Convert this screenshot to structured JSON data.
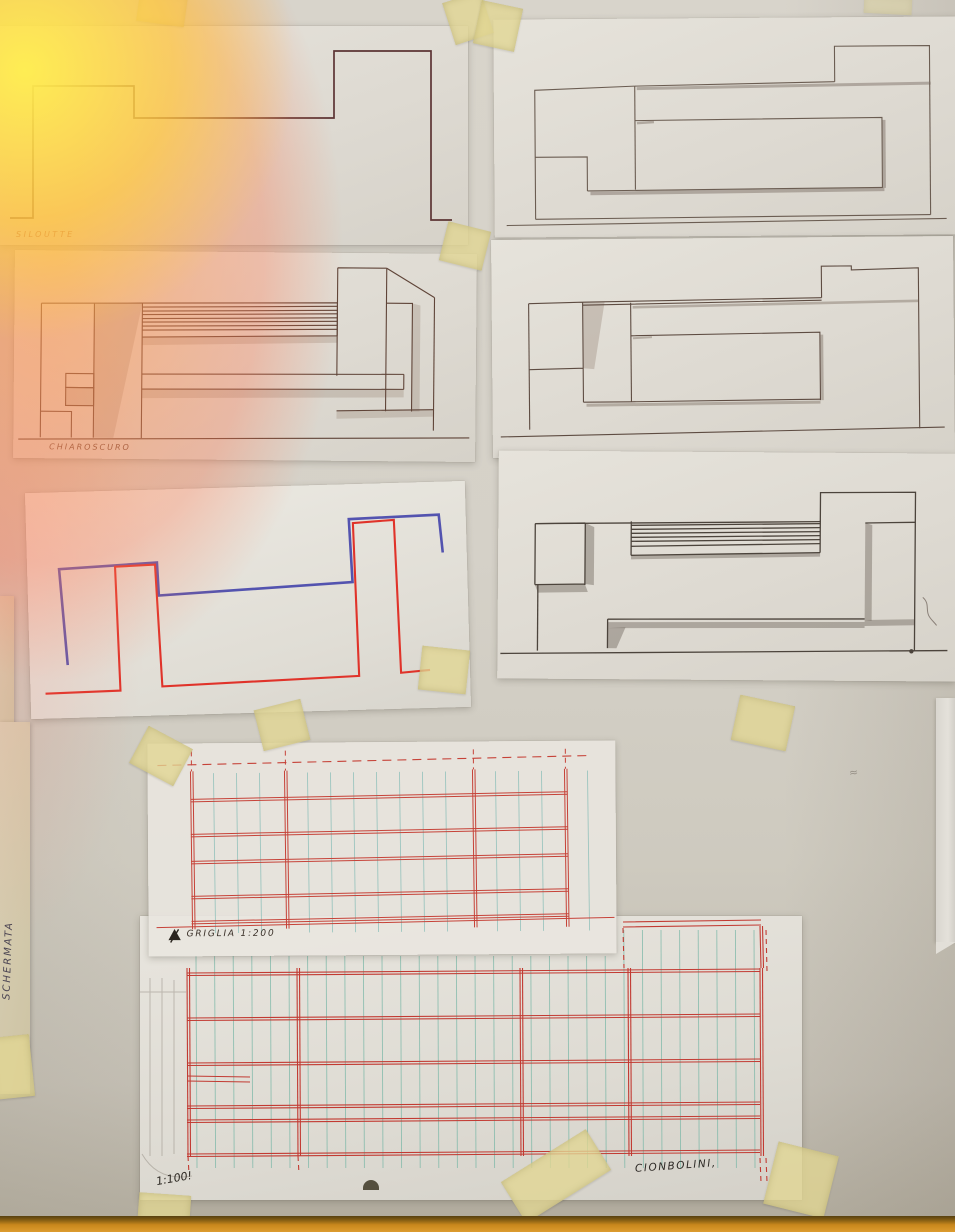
{
  "scene": {
    "type": "photograph",
    "subject": "Hand-drawn architectural elevation studies on sheets taped to a wall"
  },
  "labels": {
    "silhouette": "SILOUTTE",
    "chiaroscuro": "CHIAROSCURO",
    "griglia": "GRIGLIA 1:200",
    "final_scale": "1:100!",
    "final_title": "CIONBOLINI,",
    "left_strip": "SCHERMATA"
  },
  "colors": {
    "wall": "#d3cfc6",
    "paper": "#e2ded6",
    "ink_brown": "#5c3434",
    "pencil_gray": "#6b5d52",
    "pen_red": "#e0332a",
    "pen_blue": "#4747ab",
    "grid_red": "#c64238",
    "grid_teal": "#7cb8ae",
    "tape_yellow": "#e2d794",
    "wood_ledge": "#c8871c",
    "flare_yellow": "#ffec66",
    "flare_orange": "#ff9a4e"
  },
  "sheets": [
    {
      "id": "silhouette",
      "description": "Stepped skyline outline in dark brown ink",
      "label": "SILOUTTE"
    },
    {
      "id": "elevation-top-right",
      "description": "Pencil elevation with nested rectangles and soft shading"
    },
    {
      "id": "chiaroscuro",
      "description": "Ink elevation with hatched band and shaded blocks",
      "label": "CHIAROSCURO"
    },
    {
      "id": "elevation-middle-right",
      "description": "Pencil elevation with stepped roof and inner rectangle"
    },
    {
      "id": "red-blue-profiles",
      "description": "Overlaid red and blue skyline profiles in felt pen"
    },
    {
      "id": "elevation-lower-right",
      "description": "Pencil elevation with hatched band and heavy shading"
    },
    {
      "id": "griglia",
      "description": "Red structural grid with teal verticals on tracing paper",
      "label": "GRIGLIA 1:200"
    },
    {
      "id": "ciondolini",
      "description": "Large red grid elevation with teal verticals",
      "labels": [
        "1:100!",
        "CIONBOLINI,"
      ]
    }
  ]
}
